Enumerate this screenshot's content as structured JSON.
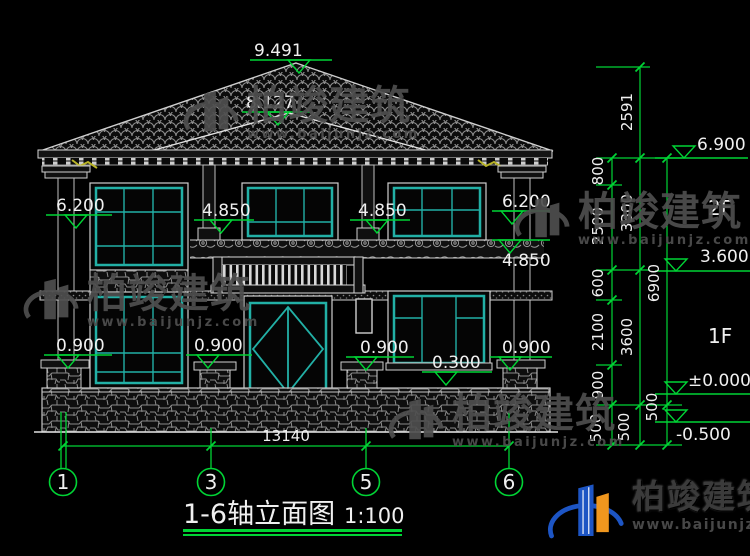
{
  "drawing": {
    "title": "1-6轴立面图",
    "scale": "1:100"
  },
  "elevation_labels": {
    "roof_peak": "9.491",
    "porch_roof": "8.127",
    "left_column_top": "6.200",
    "right_column_top": "6.200",
    "balcony_left": "4.850",
    "balcony_right": "4.850",
    "right_wall": "4.850",
    "sill_left": "0.900",
    "sill_center_left": "0.900",
    "sill_center_right": "0.900",
    "sill_right": "0.900",
    "sill_low": "0.300",
    "eave": "6.900",
    "floor2": "3.600",
    "ground": "±0.000",
    "site": "-0.500"
  },
  "dimensions": {
    "roof_height": "2591",
    "chain_inner": [
      "800",
      "2500",
      "600",
      "2100",
      "900",
      "500"
    ],
    "chain_mid": [
      "3300",
      "3600",
      "500"
    ],
    "chain_outer": [
      "6900",
      "500"
    ],
    "total_width": "13140"
  },
  "floor_tags": {
    "second": "2F",
    "first": "1F"
  },
  "axis_bubbles": [
    "1",
    "3",
    "5",
    "6"
  ],
  "watermark": {
    "brand": "柏竣建筑",
    "url": "www.baijunjz.com"
  },
  "logo": {
    "brand": "柏竣建筑",
    "url": "www.baijunjz.com"
  },
  "colors": {
    "dimension_green": "#00d435",
    "window_teal": "#22b0a6",
    "line_white": "#d8d8d8",
    "eave_accent_yellow": "#b9b428",
    "logo_blue": "#1d55c4",
    "logo_orange": "#f0971e",
    "watermark_gray": "#4f4f4f"
  }
}
